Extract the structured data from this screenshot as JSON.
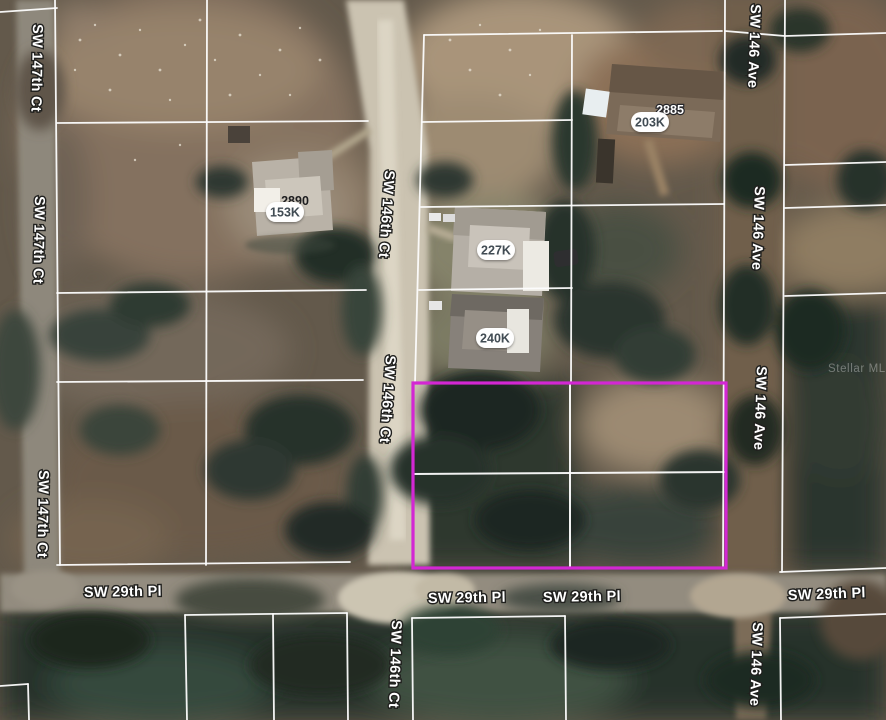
{
  "map": {
    "watermark": "Stellar MLS",
    "colors": {
      "highlight": "#d327d3",
      "parcel_line": "#ffffff"
    },
    "streets": {
      "sw_147th_ct": "SW 147th Ct",
      "sw_146th_ct": "SW 146th Ct",
      "sw_146_ave": "SW 146 Ave",
      "sw_29th_pl": "SW 29th Pl"
    },
    "price_labels": [
      {
        "id": "153k",
        "text": "153K"
      },
      {
        "id": "203k",
        "text": "203K"
      },
      {
        "id": "227k",
        "text": "227K"
      },
      {
        "id": "240k",
        "text": "240K"
      }
    ],
    "address_labels": [
      {
        "id": "a2885",
        "text": "2885"
      },
      {
        "id": "a2890",
        "text": "2890"
      }
    ]
  }
}
